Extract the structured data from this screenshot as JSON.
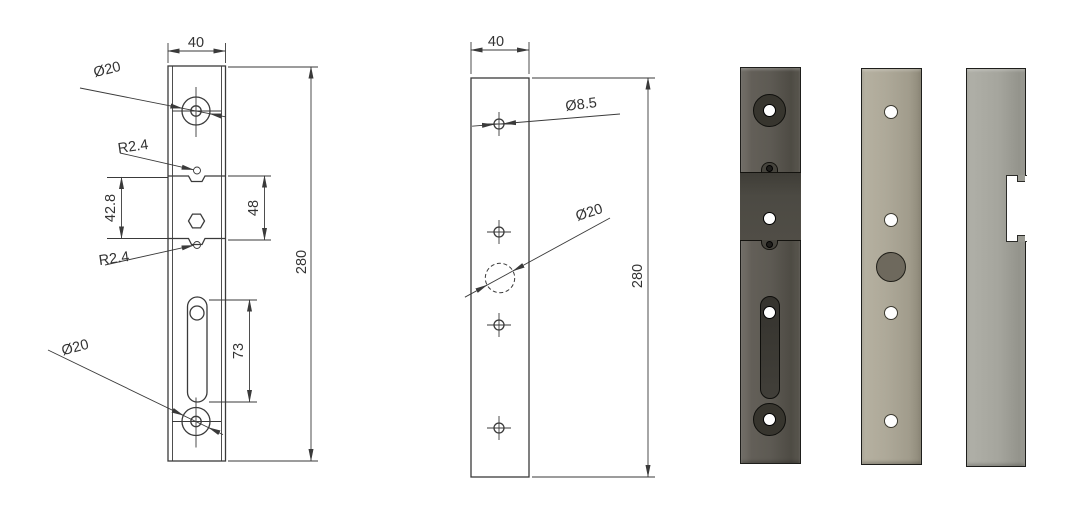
{
  "left_view": {
    "width_dim": "40",
    "top_hole_label": "Ø20",
    "top_notch_label": "R2.4",
    "pocket_span_dim": "42.8",
    "pocket_height_dim": "48",
    "bottom_notch_label": "R2.4",
    "slot_length_dim": "73",
    "bottom_hole_label": "Ø20",
    "height_dim": "280"
  },
  "middle_view": {
    "width_dim": "40",
    "small_hole_label": "Ø8.5",
    "large_hole_label": "Ø20",
    "height_dim": "280"
  },
  "colors": {
    "drawing_line": "#3a3a3a",
    "dark_plate": "#5d5a53",
    "dark_plate_recess": "#4a4841",
    "tan_plate": "#aba695",
    "side_plate": "#a3a39b",
    "recess_circle": "#6e695d"
  }
}
